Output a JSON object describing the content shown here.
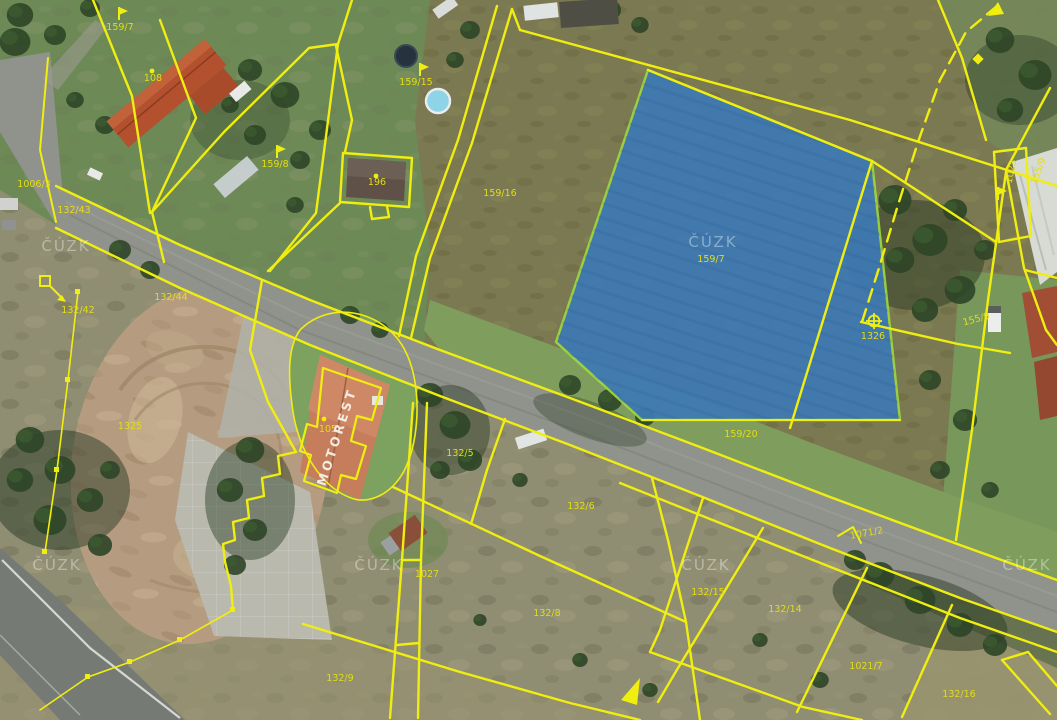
{
  "map": {
    "provider": "ČÚZK",
    "watermark_text": "ČÚZK",
    "colors": {
      "highlight_fill": "#3d7ab5",
      "highlight_border": "#9fd83c",
      "cadastral_line": "#f0ee10",
      "parcel_label": "#e3dd15",
      "building_text": "#f5f2ea",
      "watermark": "#ffffff"
    },
    "highlighted_parcel": {
      "number": "159/7"
    },
    "labels": [
      {
        "id": "parcel-159-7-nw",
        "text": "159/7"
      },
      {
        "id": "building-108",
        "text": "108"
      },
      {
        "id": "parcel-159-8",
        "text": "159/8"
      },
      {
        "id": "parcel-1006-3",
        "text": "1006/3"
      },
      {
        "id": "parcel-132-43",
        "text": "132/43"
      },
      {
        "id": "parcel-132-42",
        "text": "132/42"
      },
      {
        "id": "parcel-132-44",
        "text": "132/44"
      },
      {
        "id": "parcel-1325",
        "text": "1325"
      },
      {
        "id": "building-196",
        "text": "196"
      },
      {
        "id": "parcel-159-15",
        "text": "159/15"
      },
      {
        "id": "parcel-159-16",
        "text": "159/16"
      },
      {
        "id": "parcel-159-7-highlight",
        "text": "159/7"
      },
      {
        "id": "parcel-159-20",
        "text": "159/20"
      },
      {
        "id": "parcel-1326",
        "text": "1326"
      },
      {
        "id": "parcel-1023",
        "text": "1023"
      },
      {
        "id": "parcel-155-9",
        "text": "155/9"
      },
      {
        "id": "parcel-155-9-edge",
        "text": "155/9"
      },
      {
        "id": "building-105",
        "text": "105"
      },
      {
        "id": "parcel-132-5",
        "text": "132/5"
      },
      {
        "id": "parcel-132-6",
        "text": "132/6"
      },
      {
        "id": "parcel-1027",
        "text": "1027"
      },
      {
        "id": "parcel-132-8",
        "text": "132/8"
      },
      {
        "id": "parcel-132-9",
        "text": "132/9"
      },
      {
        "id": "road-1071-2",
        "text": "1071/2"
      },
      {
        "id": "parcel-132-15",
        "text": "132/15"
      },
      {
        "id": "parcel-132-14",
        "text": "132/14"
      },
      {
        "id": "parcel-1021-7",
        "text": "1021/7"
      },
      {
        "id": "parcel-132-16",
        "text": "132/16"
      }
    ],
    "building_label": {
      "text": "MOTOREST"
    },
    "markers": [
      {
        "type": "flag"
      },
      {
        "type": "flag"
      },
      {
        "type": "flag"
      },
      {
        "type": "flag"
      },
      {
        "type": "dot"
      },
      {
        "type": "dot"
      },
      {
        "type": "dot"
      },
      {
        "type": "circle-plus"
      },
      {
        "type": "diamond"
      },
      {
        "type": "square-with-arrow"
      },
      {
        "type": "arrow"
      },
      {
        "type": "dashed-line-arrowhead"
      }
    ]
  }
}
